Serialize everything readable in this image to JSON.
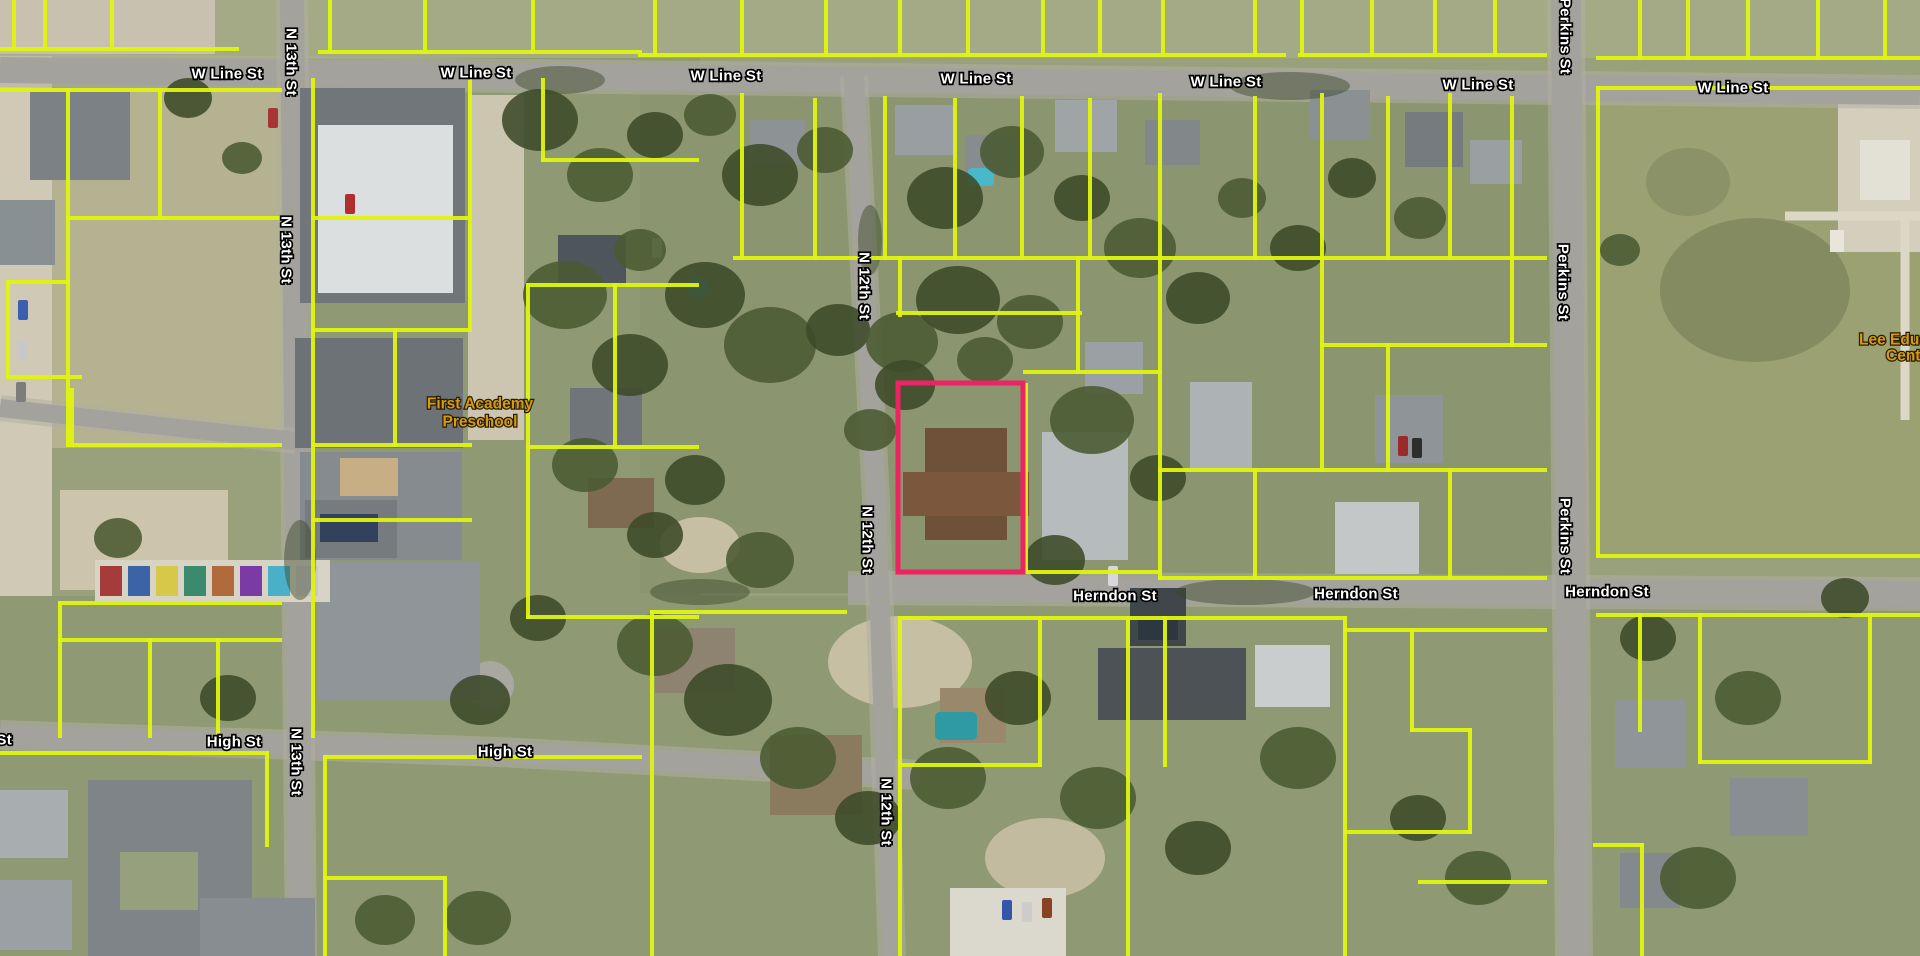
{
  "map": {
    "type": "aerial-parcel-viewer",
    "colors": {
      "highlight": "#ed2364",
      "parcel_lines": "#e0f50e",
      "street_label": "#ffffff",
      "poi_label": "#d99a12"
    },
    "highlighted_parcel": {
      "x": 898,
      "y": 383,
      "width": 125,
      "height": 189
    },
    "street_labels": [
      {
        "text": "W Line St",
        "x": 227,
        "y": 74,
        "vertical": false
      },
      {
        "text": "W Line St",
        "x": 476,
        "y": 73,
        "vertical": false
      },
      {
        "text": "W Line St",
        "x": 726,
        "y": 76,
        "vertical": false
      },
      {
        "text": "W Line St",
        "x": 976,
        "y": 79,
        "vertical": false
      },
      {
        "text": "W Line St",
        "x": 1226,
        "y": 82,
        "vertical": false
      },
      {
        "text": "W Line St",
        "x": 1478,
        "y": 85,
        "vertical": false
      },
      {
        "text": "W Line St",
        "x": 1733,
        "y": 88,
        "vertical": false
      },
      {
        "text": "Herndon St",
        "x": 1115,
        "y": 596,
        "vertical": false
      },
      {
        "text": "Herndon St",
        "x": 1356,
        "y": 594,
        "vertical": false
      },
      {
        "text": "Herndon St",
        "x": 1607,
        "y": 592,
        "vertical": false
      },
      {
        "text": "St",
        "x": 12,
        "y": 740,
        "vertical": false,
        "anchor": "end"
      },
      {
        "text": "High St",
        "x": 234,
        "y": 742,
        "vertical": false
      },
      {
        "text": "High St",
        "x": 505,
        "y": 752,
        "vertical": false
      },
      {
        "text": "N 13th St",
        "x": 291,
        "y": 62,
        "vertical": true
      },
      {
        "text": "N 13th St",
        "x": 286,
        "y": 250,
        "vertical": true
      },
      {
        "text": "N 13th St",
        "x": 296,
        "y": 762,
        "vertical": true
      },
      {
        "text": "N 12th St",
        "x": 864,
        "y": 286,
        "vertical": true
      },
      {
        "text": "N 12th St",
        "x": 867,
        "y": 540,
        "vertical": true
      },
      {
        "text": "N 12th St",
        "x": 886,
        "y": 812,
        "vertical": true
      },
      {
        "text": "Perkins St",
        "x": 1565,
        "y": 36,
        "vertical": true
      },
      {
        "text": "Perkins St",
        "x": 1563,
        "y": 282,
        "vertical": true
      },
      {
        "text": "Perkins St",
        "x": 1565,
        "y": 536,
        "vertical": true
      }
    ],
    "poi_labels": [
      {
        "text": "First Academy",
        "x": 480,
        "y": 404
      },
      {
        "text": "Preschool",
        "x": 480,
        "y": 422
      },
      {
        "text": "Lee Educa",
        "x": 1859,
        "y": 340,
        "anchor": "start"
      },
      {
        "text": "Cente",
        "x": 1886,
        "y": 356,
        "anchor": "start"
      }
    ]
  }
}
